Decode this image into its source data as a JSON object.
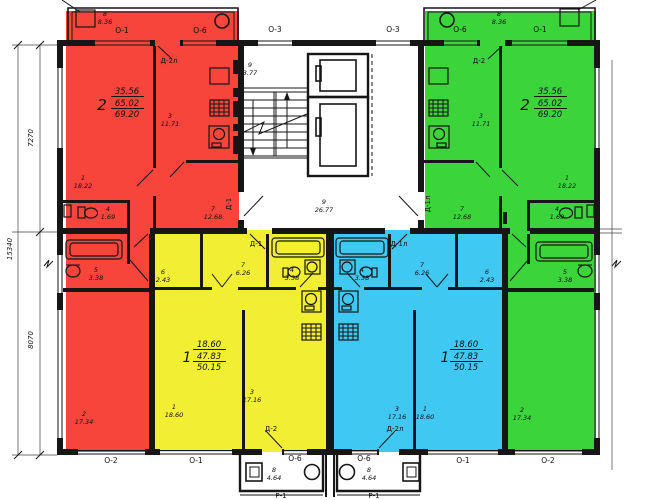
{
  "plan": {
    "windows": {
      "top": [
        "О-1",
        "О-6",
        "О-3",
        "О-3",
        "О-6",
        "О-1"
      ],
      "bottom": [
        "О-2",
        "О-1",
        "О-6",
        "О-6",
        "О-1",
        "О-2"
      ]
    },
    "dimensions": {
      "upper": "7270",
      "lower": "8070",
      "total": "15340"
    },
    "common": {
      "stair_landing": {
        "num": "9",
        "area": "3.77"
      },
      "corridor": {
        "num": "9",
        "area": "26.77"
      },
      "porch_left": {
        "num": "8",
        "area": "4.64",
        "type": "Р-1"
      },
      "porch_right": {
        "num": "8",
        "area": "4.64",
        "type": "Р-1"
      }
    },
    "apartments": {
      "red": {
        "color": "#f8453b",
        "summary": {
          "rooms": "2",
          "living": "35.56",
          "overall": "65.02",
          "total": "69.20"
        },
        "rooms": {
          "living": {
            "num": "1",
            "area": "18.22"
          },
          "bedroom": {
            "num": "2",
            "area": "17.34"
          },
          "kitchen": {
            "num": "3",
            "area": "11.71"
          },
          "wc": {
            "num": "4",
            "area": "1.69"
          },
          "bath": {
            "num": "5",
            "area": "3.38"
          },
          "hall": {
            "num": "7",
            "area": "12.68"
          },
          "balcony": {
            "num": "8",
            "area": "8.36"
          }
        },
        "doors": {
          "balcony": "Д-2л",
          "entry": "Д-1"
        }
      },
      "green": {
        "color": "#3bd53b",
        "summary": {
          "rooms": "2",
          "living": "35.56",
          "overall": "65.02",
          "total": "69.20"
        },
        "rooms": {
          "living": {
            "num": "1",
            "area": "18.22"
          },
          "bedroom": {
            "num": "2",
            "area": "17.34"
          },
          "kitchen": {
            "num": "3",
            "area": "11.71"
          },
          "wc": {
            "num": "4",
            "area": "1.69"
          },
          "bath": {
            "num": "5",
            "area": "3.38"
          },
          "hall": {
            "num": "7",
            "area": "12.68"
          },
          "balcony": {
            "num": "8",
            "area": "8.36"
          }
        },
        "doors": {
          "balcony": "Д-2",
          "entry": "Д-1л"
        }
      },
      "yellow": {
        "color": "#f2ef33",
        "summary": {
          "rooms": "1",
          "living": "18.60",
          "overall": "47.83",
          "total": "50.15"
        },
        "rooms": {
          "living": {
            "num": "1",
            "area": "18.60"
          },
          "kitchen": {
            "num": "3",
            "area": "17.16"
          },
          "bath": {
            "num": "4",
            "area": "3.38"
          },
          "storage": {
            "num": "6",
            "area": "2.43"
          },
          "hall": {
            "num": "7",
            "area": "6.26"
          }
        },
        "doors": {
          "entry": "Д-1",
          "porch": "Д-2"
        }
      },
      "blue": {
        "color": "#3fc8f2",
        "summary": {
          "rooms": "1",
          "living": "18.60",
          "overall": "47.83",
          "total": "50.15"
        },
        "rooms": {
          "living": {
            "num": "1",
            "area": "18.60"
          },
          "kitchen": {
            "num": "3",
            "area": "17.16"
          },
          "bath": {
            "num": "4",
            "area": "3.38"
          },
          "storage": {
            "num": "6",
            "area": "2.43"
          },
          "hall": {
            "num": "7",
            "area": "6.26"
          }
        },
        "doors": {
          "entry": "Д-1л",
          "porch": "Д-2л"
        }
      }
    }
  }
}
